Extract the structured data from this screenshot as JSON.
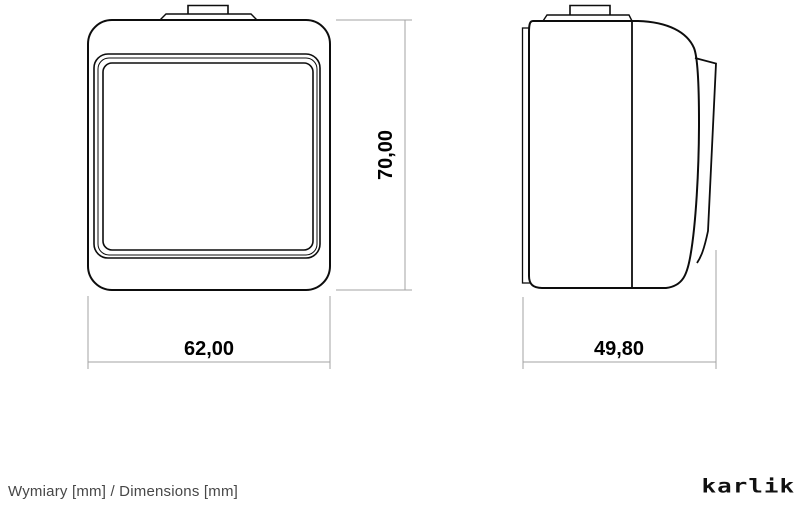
{
  "drawing": {
    "type": "technical-dimension-drawing",
    "subject": "surface-mounted electrical rocker switch, front and side projection views",
    "colors": {
      "background": "#ffffff",
      "outline": "#0d0d0d",
      "dimension_lines": "#a3a3a3",
      "dimension_text": "#000000",
      "caption_text": "#474747"
    },
    "views": {
      "front": {
        "label": "front-view",
        "width_label": "62,00",
        "height_label": "70,00"
      },
      "side": {
        "label": "side-view",
        "depth_label": "49,80"
      }
    },
    "units": "mm"
  },
  "footer": {
    "caption": "Wymiary [mm] / Dimensions [mm]",
    "logo_text": "karlik"
  }
}
